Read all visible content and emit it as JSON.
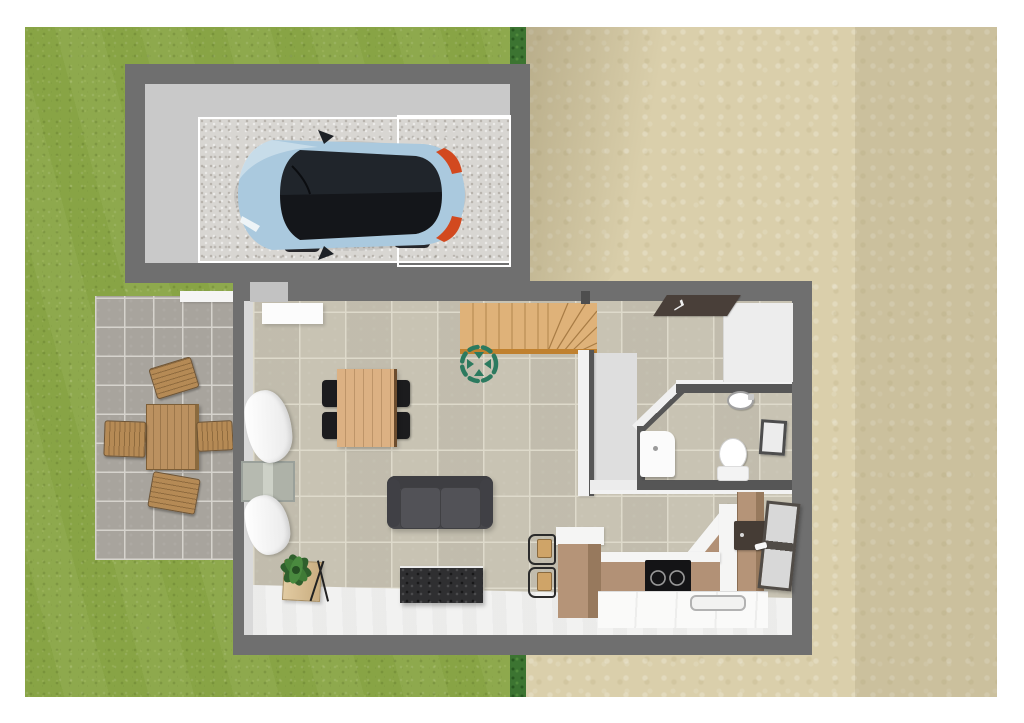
{
  "scene": {
    "description": "3D top-down rendering of a small house floor plan with attached garage, side patio, lawn and sand-colored yard",
    "style": "home-design-software render",
    "visible_text": "none"
  },
  "palette": {
    "page-bg": "#ffffff",
    "grass": "#8aa647",
    "hedge": "#3c7431",
    "sand": "#dacfab",
    "wall": "#6f6f6f",
    "partition": "#565656",
    "garage-floor": "#c9c9c9",
    "parking-pad": "#d8d6d2",
    "tile": "#c6c1b1",
    "grout": "#dedacb",
    "patio-tile": "#a8a49d",
    "patio-grout": "#d6d3cd",
    "white-floor": "#f1f1f0",
    "stair-wood": "#dfb279",
    "stair-edge": "#c0812f",
    "table-wood": "#dcb183",
    "kitchen-wood": "#b29176",
    "outdoor-wood": "#b58a55",
    "sofa": "#47474b",
    "tv-cabinet": "#2f2f31",
    "car-body": "#aac9de",
    "car-glass": "#14161a",
    "taillight": "#d2491f",
    "compass": "#2c7a5f",
    "plant": "#2f5f2c",
    "planter": "#d9c299",
    "mat": "#493f39",
    "fixture-white": "#fbfbfb"
  },
  "environment": {
    "areas": [
      {
        "name": "lawn",
        "surface": "grass",
        "position": "left"
      },
      {
        "name": "hedge",
        "surface": "shrub strip",
        "position": "center vertical"
      },
      {
        "name": "yard",
        "surface": "sand",
        "position": "right"
      }
    ]
  },
  "garage": {
    "features": [
      "speckled parking pad",
      "white garage-door zone outline"
    ],
    "vehicle": {
      "type": "hatchback car",
      "body_color": "light blue",
      "roof": "black glass",
      "facing": "west",
      "taillights": "orange-red"
    }
  },
  "patio": {
    "furniture": [
      "wooden garden table",
      "garden chair north",
      "garden chair south",
      "garden chair west",
      "garden chair east"
    ],
    "edge": "white planter strip at top"
  },
  "house": {
    "living_room": {
      "furniture": [
        "white sideboard",
        "wooden dining table",
        "four black dining chairs",
        "two-seat dark gray sofa",
        "dark TV cabinet",
        "potted plant in wooden box",
        "two windows with white curtains"
      ]
    },
    "kitchen": {
      "furniture": [
        "wooden island with white top",
        "two bar stools",
        "black induction cooktop",
        "corner counter run",
        "dark wall cabinet",
        "white sink counter",
        "glazed back door"
      ]
    },
    "bathroom": {
      "fixtures": [
        "white vanity cabinet",
        "wall-hung washbasin",
        "toilet",
        "dark framed wall mirror"
      ],
      "walls": "angled entry wall"
    },
    "entry": {
      "features": [
        "dark doormat",
        "white entry floor"
      ]
    },
    "staircase": {
      "type": "straight flight with winder turn",
      "material": "light wood"
    }
  },
  "markers": {
    "camera_marker": {
      "shape": "dashed circle with four inward arrows",
      "color": "#2c7a5f"
    }
  }
}
